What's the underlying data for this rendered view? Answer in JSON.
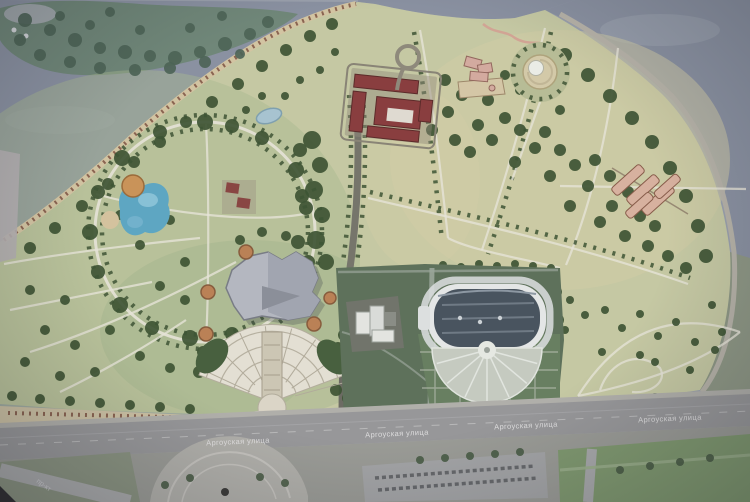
{
  "street": {
    "labels": [
      "Аргоуская улица",
      "Аргоуская улица",
      "Аргоуская улица",
      "Аргоуская улица"
    ],
    "diagonal_label": "пр-кт"
  },
  "palette": {
    "water": "#8a92a4",
    "island_trees": "#6e8878",
    "park_base": "#c7cba1",
    "meadow_green": "#a9bb8d",
    "forest_dark": "#3b5430",
    "satellite_green": "#5c7158",
    "building_red": "#8e3b3c",
    "building_gray_roof": "#b5b9c3",
    "stadium_roof": "#47535f",
    "stadium_white": "#e7e9e9",
    "street_asphalt": "#98989a",
    "footpath": "#e9e6d8",
    "embankment": "#d6c6a0",
    "plaza_node_orange": "#c08050",
    "play_water_blue": "#58a8c8"
  }
}
